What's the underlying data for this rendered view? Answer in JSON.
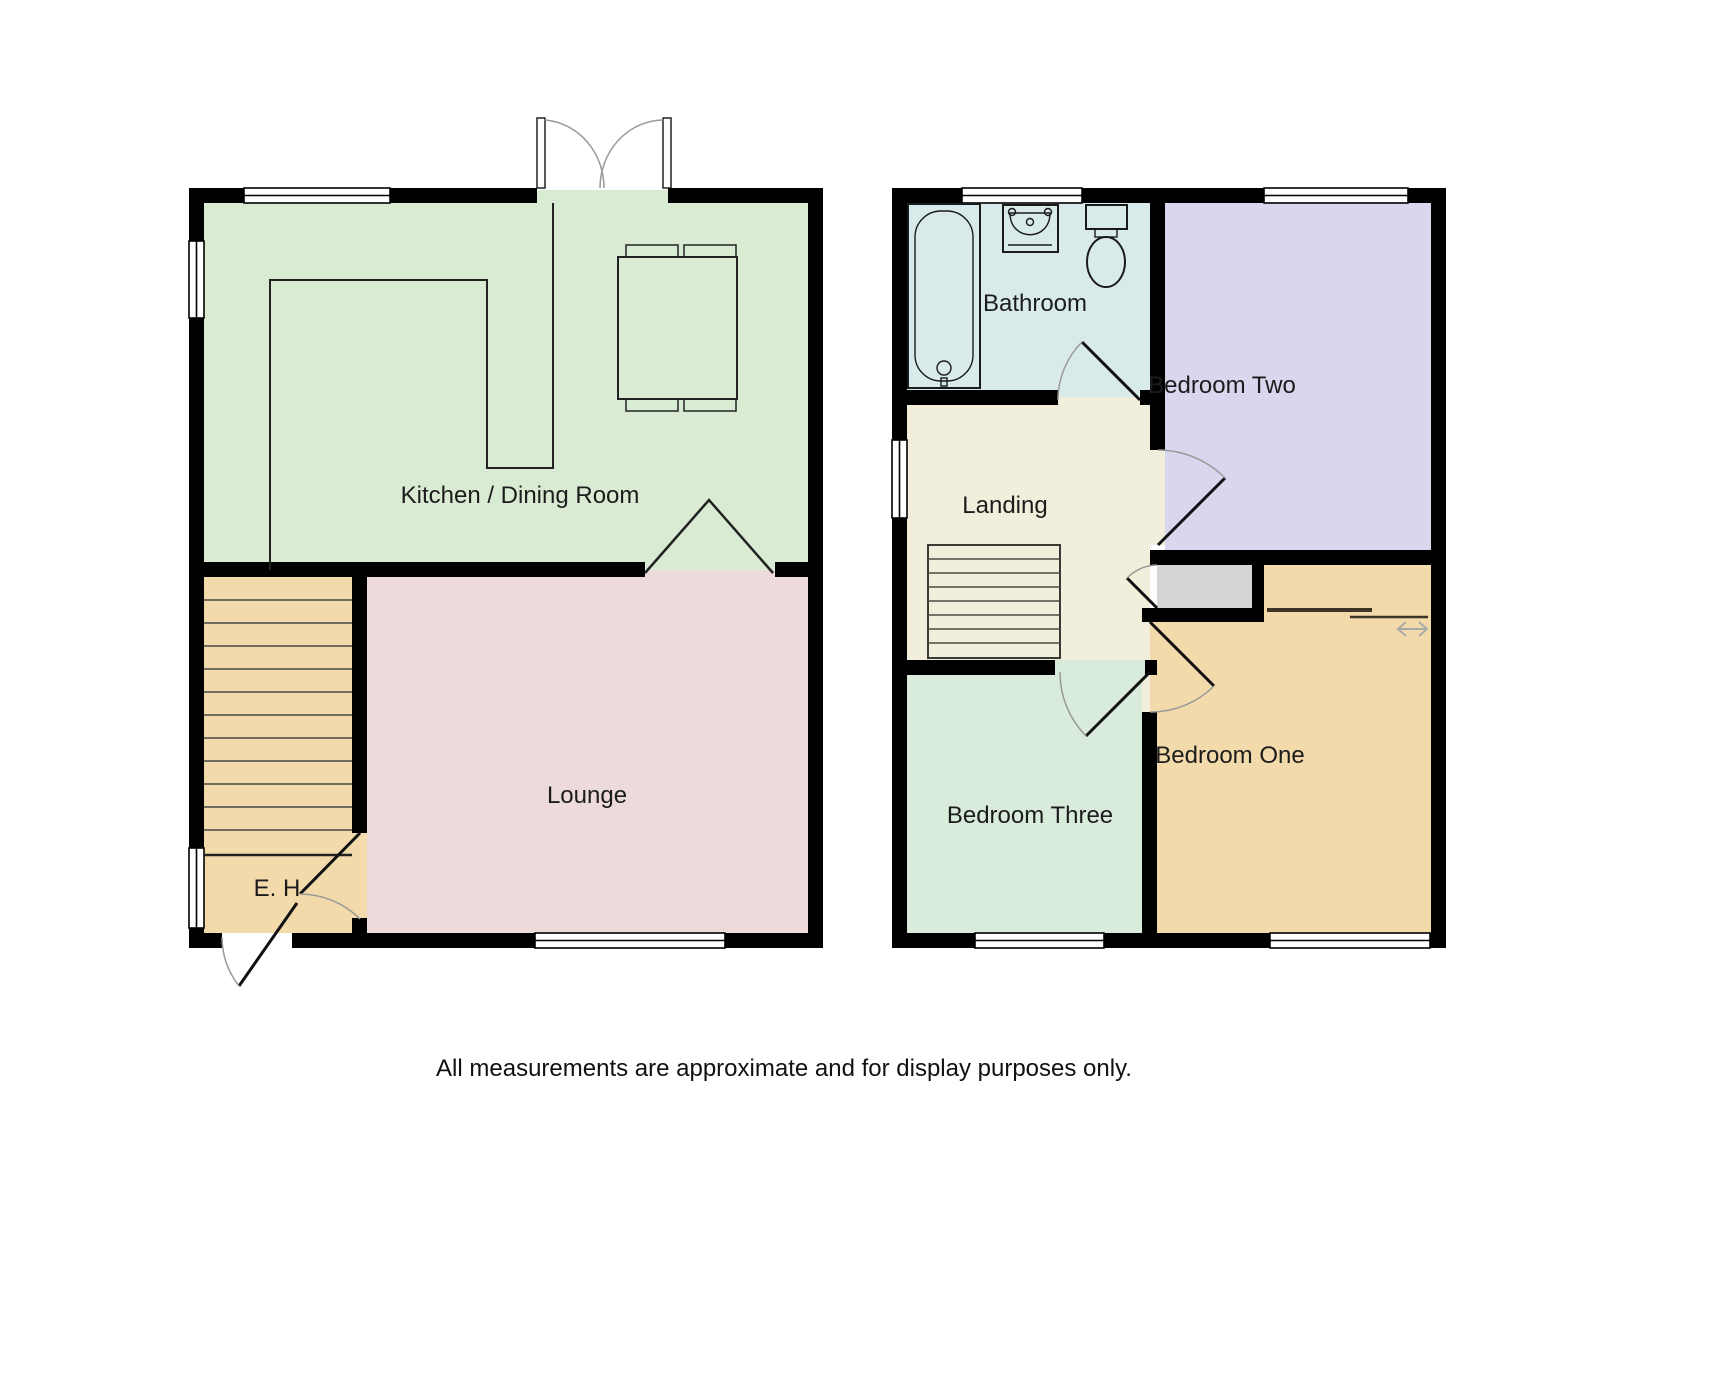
{
  "disclaimer": "All measurements are approximate and for display purposes only.",
  "palette": {
    "wall": "#000000",
    "window": "#ffffff",
    "door_arc": "#999999",
    "opening_symbol": "#222222"
  },
  "floors": {
    "ground": {
      "rooms": {
        "kitchen_dining": {
          "label": "Kitchen / Dining Room",
          "color": "#d9ecd3",
          "features": [
            "french-doors",
            "window-top",
            "window-left",
            "kitchen-counter",
            "dining-table-with-four-chairs",
            "open-arch-to-lounge"
          ]
        },
        "lounge": {
          "label": "Lounge",
          "color": "#eddadb",
          "features": [
            "window-bottom",
            "door-from-hall"
          ]
        },
        "entrance_hall": {
          "label": "E. H",
          "color": "#f2daab",
          "features": [
            "front-door",
            "window-left",
            "staircase-up",
            "door-to-lounge"
          ]
        }
      }
    },
    "first": {
      "rooms": {
        "bathroom": {
          "label": "Bathroom",
          "color": "#d9eaea",
          "features": [
            "bath",
            "sink",
            "toilet",
            "window-top",
            "door-from-landing"
          ]
        },
        "bedroom_two": {
          "label": "Bedroom Two",
          "color": "#d8d7ee",
          "features": [
            "window-top",
            "door-from-landing"
          ]
        },
        "landing": {
          "label": "Landing",
          "color": "#f1eedb",
          "features": [
            "window-left",
            "staircase-down",
            "cupboard-door"
          ]
        },
        "cupboard": {
          "color": "#d5d4d6",
          "features": [
            "door-from-landing"
          ]
        },
        "bedroom_three": {
          "label": "Bedroom Three",
          "color": "#d9ecdc",
          "features": [
            "window-bottom",
            "door-from-landing"
          ]
        },
        "bedroom_one": {
          "label": "Bedroom One",
          "color": "#f2daab",
          "features": [
            "window-bottom",
            "door-from-landing",
            "built-in-wardrobe-sliding-doors"
          ]
        }
      }
    }
  }
}
